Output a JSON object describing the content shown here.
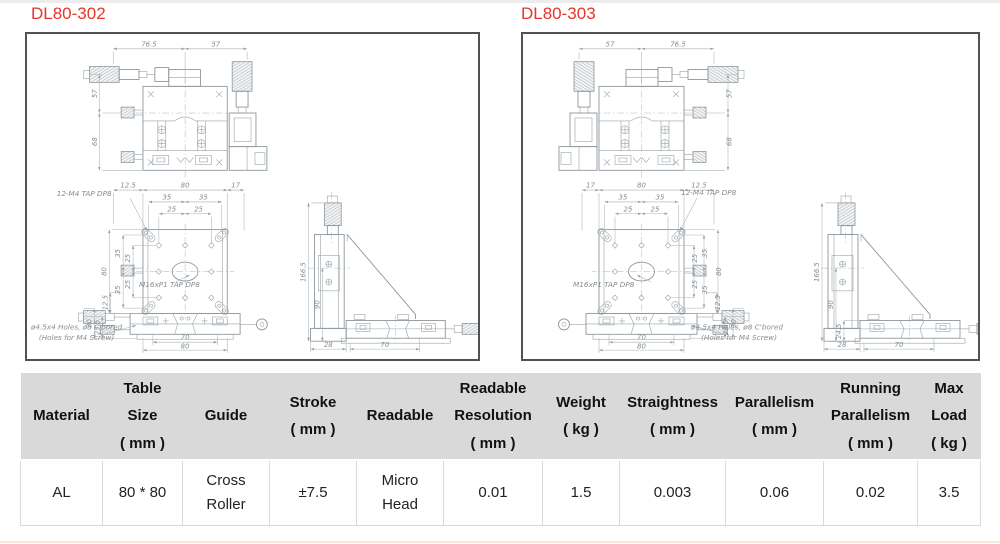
{
  "titles": {
    "left": "DL80-302",
    "right": "DL80-303"
  },
  "colors": {
    "title_red": "#e8352b",
    "line": "#8d969c",
    "dim_text": "#868c91",
    "table_header_bg": "#d9d9d9",
    "table_border": "#d9d9d9",
    "box_border": "#515151"
  },
  "dwgL": {
    "tv": {
      "top1": "76.5",
      "top2": "57",
      "side1": "57",
      "side2": "68"
    },
    "fv": {
      "t1": "12.5",
      "t2": "80",
      "t3": "17",
      "t4": "35",
      "t5": "35",
      "t6": "25",
      "t7": "25",
      "s1": "80",
      "s2": "35",
      "s3": "35",
      "s4": "25",
      "s5": "25",
      "g1": "12.5",
      "g2": "30",
      "g3": "23.5",
      "b1": "70",
      "b2": "80",
      "a1": "12-M4 TAP DP8",
      "a2": "M16xP1 TAP DP8",
      "a3": "ø4.5x4 Holes, ø8 C'bored",
      "a4": "(Holes for M4 Screw)"
    },
    "sv": {
      "h1": "166.5",
      "h2": "90",
      "b1": "28",
      "b2": "70"
    }
  },
  "dwgR": {
    "tv": {
      "top1": "57",
      "top2": "76.5",
      "side1": "57",
      "side2": "68"
    },
    "fv": {
      "t1": "17",
      "t2": "80",
      "t3": "12.5",
      "t4": "35",
      "t5": "35",
      "t6": "25",
      "t7": "25",
      "s1": "80",
      "s2": "35",
      "s3": "35",
      "s4": "25",
      "s5": "25",
      "g1": "12.5",
      "g2": "30",
      "g3": "23.5",
      "b1": "70",
      "b2": "80",
      "a1": "12-M4 TAP DP8",
      "a2": "M16xP1 TAP DP8",
      "a3": "ø4.5x4 Holes, ø8 C'bored",
      "a4": "(Holes for M4 Screw)"
    },
    "sv": {
      "h1": "166.5",
      "h2": "90",
      "h3": "24.5",
      "b1": "28",
      "b2": "70"
    }
  },
  "table": {
    "headers": [
      "Material",
      "Table\nSize\n( mm )",
      "Guide",
      "Stroke\n( mm )",
      "Readable",
      "Readable\nResolution\n( mm )",
      "Weight\n( kg )",
      "Straightness\n( mm )",
      "Parallelism\n( mm )",
      "Running\nParallelism\n( mm )",
      "Max\nLoad\n( kg )"
    ],
    "row": [
      "AL",
      "80 * 80",
      "Cross\nRoller",
      "±7.5",
      "Micro\nHead",
      "0.01",
      "1.5",
      "0.003",
      "0.06",
      "0.02",
      "3.5"
    ]
  }
}
